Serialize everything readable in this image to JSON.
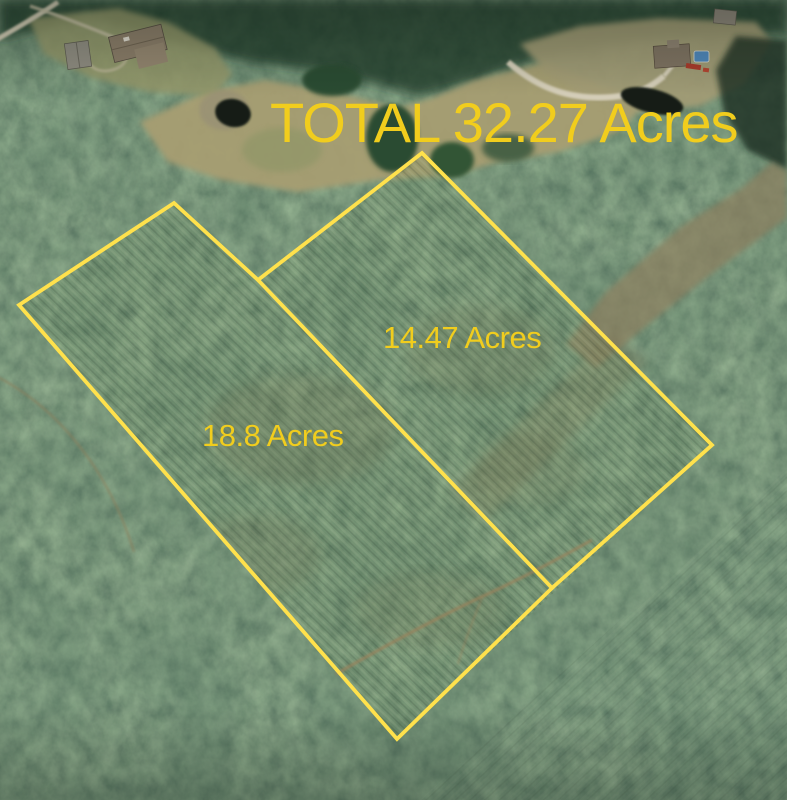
{
  "map": {
    "title": "TOTAL 32.27 Acres",
    "total_acres": "32.27",
    "boundary_color": "#ffe14c",
    "label_color": "#f1cd1d",
    "combined_outline": "19,305 174,203 258,280 422,153 712,445 397,739"
  },
  "parcels": {
    "left": {
      "label": "18.8 Acres",
      "acres": "18.8",
      "outline_open": "258,280 174,203 19,305 397,739 552,588"
    },
    "right": {
      "label": "14.47 Acres",
      "acres": "14.47",
      "outline": "258,280 422,153 712,445 552,588"
    }
  }
}
